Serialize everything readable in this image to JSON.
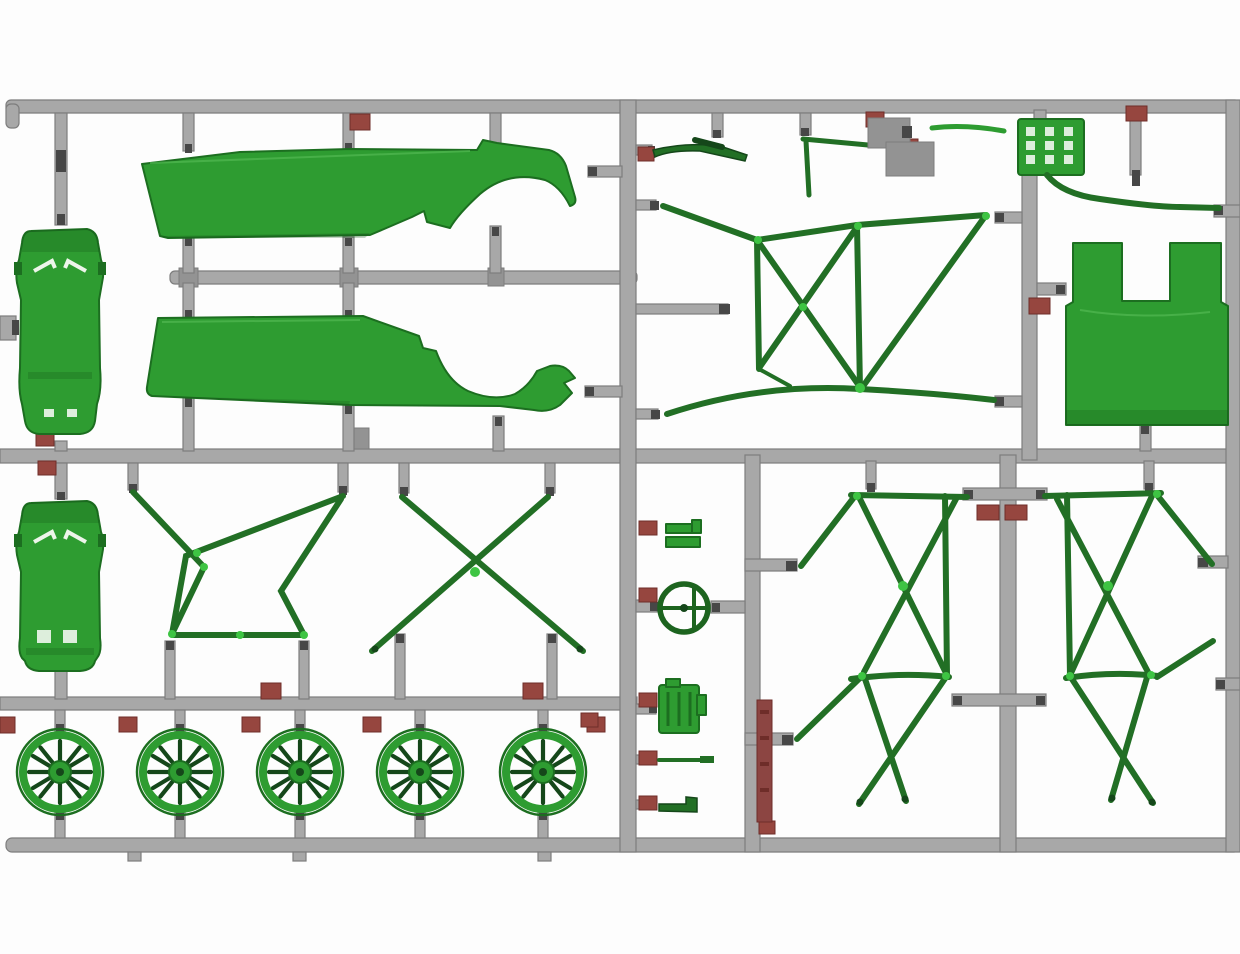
{
  "meta": {
    "description": "Photograph of a plastic scale-model kit sprue (parts tree): grey runner frame holding green injection-moulded rally-car parts, with small maroon part-number tabs at the runner junctions",
    "plastic_color_name": "green",
    "runner_color_name": "grey"
  },
  "colors": {
    "bg": "#fdfdfd",
    "runner": "#a8a8a8",
    "runner-edge": "#7d7d7d",
    "runner-dark": "#474747",
    "part": "#2e9c31",
    "part-dark": "#1c6e20",
    "part-bright": "#45b948",
    "tube": "#226f25",
    "tube-dark": "#15471a",
    "tag": "#96463f",
    "tag-dark": "#6e2d29",
    "strip": "#8c4542",
    "wdet": "#edf5ea",
    "hl": "#3ec443"
  },
  "parts": {
    "sprue": "grey sprue runner frame",
    "car_body_a": "car body shell, top view (upper)",
    "car_body_b": "car body shell, top view (lower)",
    "panel_upper": "body side panel with rear wheel arch (upper)",
    "panel_lower": "body side panel with rear wheel arch (lower)",
    "cage_hoop": "roll-cage side hoop with bottom bar",
    "x_brace": "roll-cage X cross-brace",
    "wheel": "12-spoke wheel rim",
    "rear_cage": "rear roll-cage / subframe assembly",
    "grille": "radiator grille panel",
    "bulkhead": "bulkhead panel with U-shaped notch",
    "curved_rod": "curved chassis rod",
    "steering_wheel": "steering wheel",
    "engine_block": "gearbox / engine block",
    "clip": "small clip part",
    "rod": "linkage rod",
    "l_bracket": "small L-bracket",
    "wiper": "wiper-arm lever",
    "t_rod": "T-shaped rod",
    "bracket_assembly": "moulding bracket with tabs",
    "tag": "maroon part-number tab",
    "strip": "maroon marking strip"
  },
  "counts": {
    "wheels": 5,
    "number_tags": 24
  }
}
